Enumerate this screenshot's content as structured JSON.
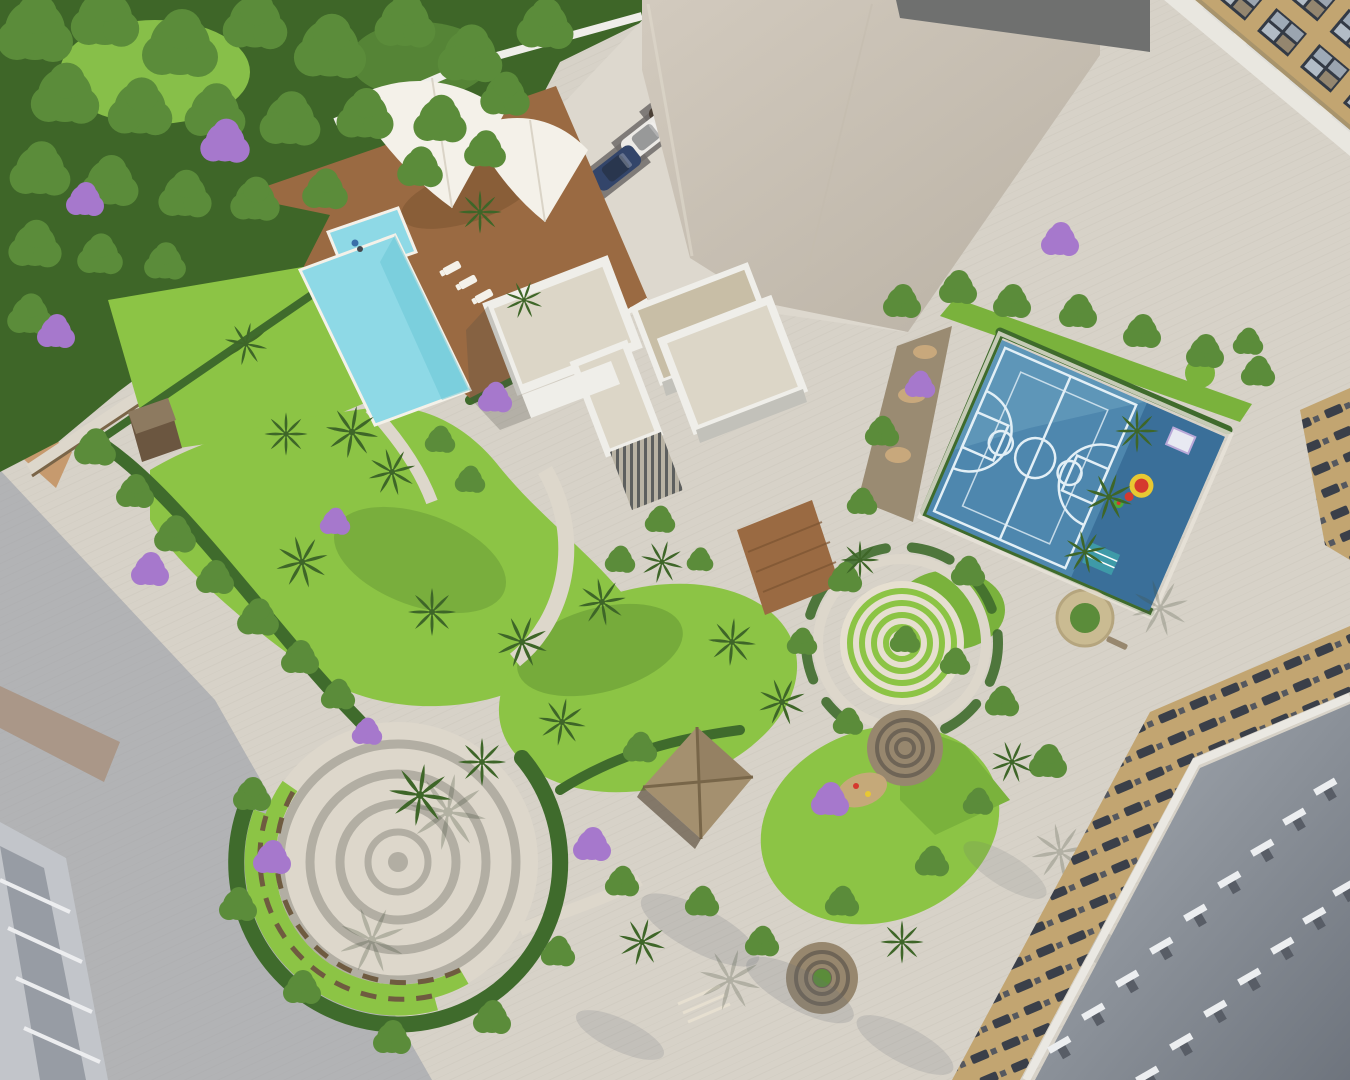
{
  "scene": {
    "description": "Aerial 3D architectural rendering of a residential complex amenity podium: landscaped gardens, L-shaped swimming pool with wooden deck and white tensile canopy, white clubhouse, blue multi-sport court with kids play zone, circular amphitheatre plaza, labyrinth garden, thatched gazebo, parking row with six cars, surrounded by high-rise towers and paved promenades",
    "time_of_day": "daytime, long diagonal shadows",
    "no_visible_text": true
  },
  "colors": {
    "pavement": "#d7d2c8",
    "pavementLight": "#ddd8ce",
    "plazaLight": "#ddd7cb",
    "shadowBlue": "#8e93a2",
    "shadowSoft": "#6a7078",
    "tanBand": "#c69a6e",
    "tanBandWarm": "#bd8f78",
    "forestDeep": "#3e6628",
    "forestMid": "#5b8c3a",
    "grassLight": "#8fc94c",
    "lawnBright": "#8cc445",
    "lawnMid": "#7ab23c",
    "lawnShade": "#55882e",
    "hedge": "#3f6b2c",
    "purple": "#a678cc",
    "poolBlue": "#8ed9e6",
    "poolDeep": "#6cc6d6",
    "deckBrown": "#9a6a42",
    "deckShade": "#7c5432",
    "canopyWhite": "#f4f1e9",
    "canopyShade": "#cfc8b8",
    "courtBlue": "#4e87ae",
    "courtLight": "#74a9c6",
    "courtDark": "#3a6f99",
    "courtLine": "#e2eff6",
    "wallWhite": "#efeee9",
    "wallShade": "#c2c1ba",
    "roofBeige": "#dcd6c7",
    "boxTan": "#c8bea6",
    "louverBase": "#b9b3a4",
    "towerA": "#d2cabe",
    "towerB": "#b9b1a4",
    "darkWedge": "#6f706f",
    "bldgTan": "#c2a571",
    "winDark": "#333a45",
    "winLight": "#c8d3dd",
    "railWhite": "#eae8e2",
    "roofGreyA": "#a8aeb5",
    "roofGreyB": "#6e747d",
    "ventLight": "#eceef0",
    "ventDark": "#585d66",
    "stoneBrown": "#97876e",
    "stoneRing": "#6e6456",
    "ringGrey": "#b2aea3",
    "cream": "#e6dfd0",
    "benchBrown": "#6f5b40",
    "sand": "#c8a87c",
    "matTeal": "#3e9aa8",
    "matWhite": "#e8e9f2",
    "playRed": "#d5392e",
    "playYellow": "#e8c832",
    "playGreen": "#4ca93c",
    "fence": "#7a6548",
    "shedDark": "#6b5640",
    "shedRoof": "#8d7a60",
    "personBlue": "#3a6fa8",
    "bldgGrey": "#c2c5ca",
    "bldgGreyDark": "#80868f",
    "ledgeWhite": "#ecedef"
  },
  "placements": {
    "forest_trees": [
      {
        "x": 35,
        "y": 30,
        "s": 2.0
      },
      {
        "x": 105,
        "y": 18,
        "s": 1.8
      },
      {
        "x": 180,
        "y": 45,
        "s": 2.0
      },
      {
        "x": 255,
        "y": 22,
        "s": 1.7
      },
      {
        "x": 330,
        "y": 48,
        "s": 1.9
      },
      {
        "x": 405,
        "y": 22,
        "s": 1.6
      },
      {
        "x": 470,
        "y": 55,
        "s": 1.7
      },
      {
        "x": 545,
        "y": 25,
        "s": 1.5
      },
      {
        "x": 65,
        "y": 95,
        "s": 1.8
      },
      {
        "x": 140,
        "y": 108,
        "s": 1.7
      },
      {
        "x": 215,
        "y": 112,
        "s": 1.6
      },
      {
        "x": 290,
        "y": 120,
        "s": 1.6
      },
      {
        "x": 365,
        "y": 115,
        "s": 1.5
      },
      {
        "x": 440,
        "y": 120,
        "s": 1.4
      },
      {
        "x": 505,
        "y": 95,
        "s": 1.3
      },
      {
        "x": 40,
        "y": 170,
        "s": 1.6
      },
      {
        "x": 110,
        "y": 182,
        "s": 1.5
      },
      {
        "x": 185,
        "y": 195,
        "s": 1.4
      },
      {
        "x": 255,
        "y": 200,
        "s": 1.3
      },
      {
        "x": 325,
        "y": 190,
        "s": 1.2
      },
      {
        "x": 35,
        "y": 245,
        "s": 1.4
      },
      {
        "x": 100,
        "y": 255,
        "s": 1.2
      },
      {
        "x": 165,
        "y": 262,
        "s": 1.1
      },
      {
        "x": 30,
        "y": 315,
        "s": 1.2
      },
      {
        "x": 420,
        "y": 168,
        "s": 1.2
      },
      {
        "x": 485,
        "y": 150,
        "s": 1.1
      }
    ],
    "garden_trees": [
      {
        "x": 95,
        "y": 448,
        "s": 1.1
      },
      {
        "x": 135,
        "y": 492,
        "s": 1.0
      },
      {
        "x": 175,
        "y": 535,
        "s": 1.1
      },
      {
        "x": 215,
        "y": 578,
        "s": 1.0
      },
      {
        "x": 258,
        "y": 618,
        "s": 1.1
      },
      {
        "x": 300,
        "y": 658,
        "s": 1.0
      },
      {
        "x": 338,
        "y": 695,
        "s": 0.9
      },
      {
        "x": 252,
        "y": 795,
        "s": 1.0
      },
      {
        "x": 238,
        "y": 905,
        "s": 1.0
      },
      {
        "x": 302,
        "y": 988,
        "s": 1.0
      },
      {
        "x": 392,
        "y": 1038,
        "s": 1.0
      },
      {
        "x": 492,
        "y": 1018,
        "s": 1.0
      },
      {
        "x": 558,
        "y": 952,
        "s": 0.9
      },
      {
        "x": 640,
        "y": 748,
        "s": 0.9
      },
      {
        "x": 622,
        "y": 882,
        "s": 0.9
      },
      {
        "x": 702,
        "y": 902,
        "s": 0.9
      },
      {
        "x": 762,
        "y": 942,
        "s": 0.9
      },
      {
        "x": 842,
        "y": 902,
        "s": 0.9
      },
      {
        "x": 932,
        "y": 862,
        "s": 0.9
      },
      {
        "x": 978,
        "y": 802,
        "s": 0.8
      },
      {
        "x": 1002,
        "y": 702,
        "s": 0.9
      },
      {
        "x": 1048,
        "y": 762,
        "s": 1.0
      },
      {
        "x": 968,
        "y": 572,
        "s": 0.9
      },
      {
        "x": 845,
        "y": 578,
        "s": 0.9
      },
      {
        "x": 802,
        "y": 642,
        "s": 0.8
      },
      {
        "x": 848,
        "y": 722,
        "s": 0.8
      },
      {
        "x": 882,
        "y": 432,
        "s": 0.9
      },
      {
        "x": 862,
        "y": 502,
        "s": 0.8
      },
      {
        "x": 902,
        "y": 302,
        "s": 1.0
      },
      {
        "x": 958,
        "y": 288,
        "s": 1.0
      },
      {
        "x": 1012,
        "y": 302,
        "s": 1.0
      },
      {
        "x": 1078,
        "y": 312,
        "s": 1.0
      },
      {
        "x": 1142,
        "y": 332,
        "s": 1.0
      },
      {
        "x": 1205,
        "y": 352,
        "s": 1.0
      },
      {
        "x": 1258,
        "y": 372,
        "s": 0.9
      },
      {
        "x": 1248,
        "y": 342,
        "s": 0.8
      },
      {
        "x": 905,
        "y": 640,
        "s": 0.8
      },
      {
        "x": 955,
        "y": 662,
        "s": 0.8
      },
      {
        "x": 660,
        "y": 520,
        "s": 0.8
      },
      {
        "x": 620,
        "y": 560,
        "s": 0.8
      },
      {
        "x": 700,
        "y": 560,
        "s": 0.7
      },
      {
        "x": 470,
        "y": 480,
        "s": 0.8
      },
      {
        "x": 440,
        "y": 440,
        "s": 0.8
      }
    ],
    "palms": [
      {
        "x": 352,
        "y": 432,
        "s": 1.1,
        "r": 10
      },
      {
        "x": 392,
        "y": 472,
        "s": 1.0,
        "r": -15
      },
      {
        "x": 302,
        "y": 562,
        "s": 1.1,
        "r": 30
      },
      {
        "x": 432,
        "y": 612,
        "s": 1.0,
        "r": 0
      },
      {
        "x": 522,
        "y": 642,
        "s": 1.1,
        "r": 20
      },
      {
        "x": 602,
        "y": 602,
        "s": 1.0,
        "r": -10
      },
      {
        "x": 662,
        "y": 562,
        "s": 0.9,
        "r": 15
      },
      {
        "x": 732,
        "y": 642,
        "s": 1.0,
        "r": 5
      },
      {
        "x": 782,
        "y": 702,
        "s": 1.0,
        "r": -20
      },
      {
        "x": 562,
        "y": 722,
        "s": 1.0,
        "r": 10
      },
      {
        "x": 482,
        "y": 762,
        "s": 1.0,
        "r": 0
      },
      {
        "x": 642,
        "y": 942,
        "s": 1.0,
        "r": 15
      },
      {
        "x": 902,
        "y": 942,
        "s": 0.9,
        "r": 0
      },
      {
        "x": 1012,
        "y": 762,
        "s": 0.9,
        "r": 25
      },
      {
        "x": 1137,
        "y": 431,
        "s": 0.9,
        "r": 0
      },
      {
        "x": 1109,
        "y": 497,
        "s": 1.0,
        "r": 18
      },
      {
        "x": 1085,
        "y": 552,
        "s": 0.9,
        "r": -12
      },
      {
        "x": 286,
        "y": 434,
        "s": 0.9,
        "r": 0
      },
      {
        "x": 246,
        "y": 344,
        "s": 0.9,
        "r": 12
      },
      {
        "x": 480,
        "y": 212,
        "s": 0.9,
        "r": 0
      },
      {
        "x": 524,
        "y": 300,
        "s": 0.8,
        "r": 20
      },
      {
        "x": 860,
        "y": 560,
        "s": 0.8,
        "r": 0
      },
      {
        "x": 420,
        "y": 795,
        "s": 1.3,
        "r": 8
      }
    ],
    "palm_shadows": [
      {
        "x": 448,
        "y": 812,
        "s": 1.6,
        "r": 10,
        "o": 0.28
      },
      {
        "x": 372,
        "y": 940,
        "s": 1.4,
        "r": -20,
        "o": 0.28
      },
      {
        "x": 1160,
        "y": 608,
        "s": 1.2,
        "r": 30,
        "o": 0.25
      },
      {
        "x": 1060,
        "y": 852,
        "s": 1.2,
        "r": -10,
        "o": 0.25
      },
      {
        "x": 730,
        "y": 980,
        "s": 1.3,
        "r": 15,
        "o": 0.25
      }
    ],
    "purple_trees": [
      {
        "x": 225,
        "y": 142,
        "s": 1.3
      },
      {
        "x": 85,
        "y": 200,
        "s": 1.0
      },
      {
        "x": 56,
        "y": 332,
        "s": 1.0
      },
      {
        "x": 495,
        "y": 398,
        "s": 0.9
      },
      {
        "x": 150,
        "y": 570,
        "s": 1.0
      },
      {
        "x": 335,
        "y": 522,
        "s": 0.8
      },
      {
        "x": 367,
        "y": 732,
        "s": 0.8
      },
      {
        "x": 272,
        "y": 858,
        "s": 1.0
      },
      {
        "x": 592,
        "y": 845,
        "s": 1.0
      },
      {
        "x": 830,
        "y": 800,
        "s": 1.0
      },
      {
        "x": 1060,
        "y": 240,
        "s": 1.0
      },
      {
        "x": 920,
        "y": 385,
        "s": 0.8
      }
    ],
    "loungers": [
      {
        "x": 452,
        "y": 268,
        "r": -28
      },
      {
        "x": 468,
        "y": 282,
        "r": -28
      },
      {
        "x": 484,
        "y": 296,
        "r": -28
      },
      {
        "x": 500,
        "y": 311,
        "r": -28
      },
      {
        "x": 543,
        "y": 300,
        "r": -28
      },
      {
        "x": 558,
        "y": 314,
        "r": -28
      },
      {
        "x": 573,
        "y": 329,
        "r": -28
      },
      {
        "x": 590,
        "y": 344,
        "r": -28
      }
    ],
    "parking_pads": [
      {
        "x": 757,
        "y": 20,
        "r": -38
      },
      {
        "x": 731,
        "y": 52,
        "r": -38
      },
      {
        "x": 702,
        "y": 78,
        "r": -38
      },
      {
        "x": 674,
        "y": 106,
        "r": -38
      },
      {
        "x": 646,
        "y": 137,
        "r": -38
      },
      {
        "x": 616,
        "y": 168,
        "r": -38
      }
    ],
    "cars": [
      {
        "x": 757,
        "y": 20,
        "r": -38,
        "c": "#474c54"
      },
      {
        "x": 731,
        "y": 52,
        "r": -38,
        "c": "#c8ccd1"
      },
      {
        "x": 702,
        "y": 78,
        "r": -38,
        "c": "#2e3d57"
      },
      {
        "x": 674,
        "y": 106,
        "r": -38,
        "c": "#4a3f35"
      },
      {
        "x": 646,
        "y": 137,
        "r": -38,
        "c": "#eceae6"
      },
      {
        "x": 616,
        "y": 168,
        "r": -38,
        "c": "#33456a"
      }
    ],
    "roof_vents": [
      {
        "x": 1060,
        "y": 1046,
        "r": -30
      },
      {
        "x": 1094,
        "y": 1013,
        "r": -30
      },
      {
        "x": 1128,
        "y": 980,
        "r": -30
      },
      {
        "x": 1162,
        "y": 947,
        "r": -30
      },
      {
        "x": 1196,
        "y": 914,
        "r": -30
      },
      {
        "x": 1230,
        "y": 881,
        "r": -30
      },
      {
        "x": 1263,
        "y": 849,
        "r": -30
      },
      {
        "x": 1295,
        "y": 818,
        "r": -30
      },
      {
        "x": 1326,
        "y": 788,
        "r": -30
      },
      {
        "x": 1148,
        "y": 1076,
        "r": -30
      },
      {
        "x": 1182,
        "y": 1043,
        "r": -30
      },
      {
        "x": 1216,
        "y": 1010,
        "r": -30
      },
      {
        "x": 1250,
        "y": 978,
        "r": -30
      },
      {
        "x": 1283,
        "y": 947,
        "r": -30
      },
      {
        "x": 1315,
        "y": 917,
        "r": -30
      },
      {
        "x": 1345,
        "y": 889,
        "r": -30
      }
    ],
    "ground_shadows": [
      {
        "x": 700,
        "y": 930,
        "s": 2.2,
        "r": 28,
        "o": 0.2
      },
      {
        "x": 800,
        "y": 990,
        "s": 2.0,
        "r": 28,
        "o": 0.2
      },
      {
        "x": 905,
        "y": 1045,
        "s": 1.8,
        "r": 28,
        "o": 0.18
      },
      {
        "x": 620,
        "y": 1035,
        "s": 1.6,
        "r": 25,
        "o": 0.18
      },
      {
        "x": 1005,
        "y": 870,
        "s": 1.6,
        "r": 32,
        "o": 0.16
      },
      {
        "x": 1105,
        "y": 950,
        "s": 1.6,
        "r": 32,
        "o": 0.16
      }
    ]
  }
}
